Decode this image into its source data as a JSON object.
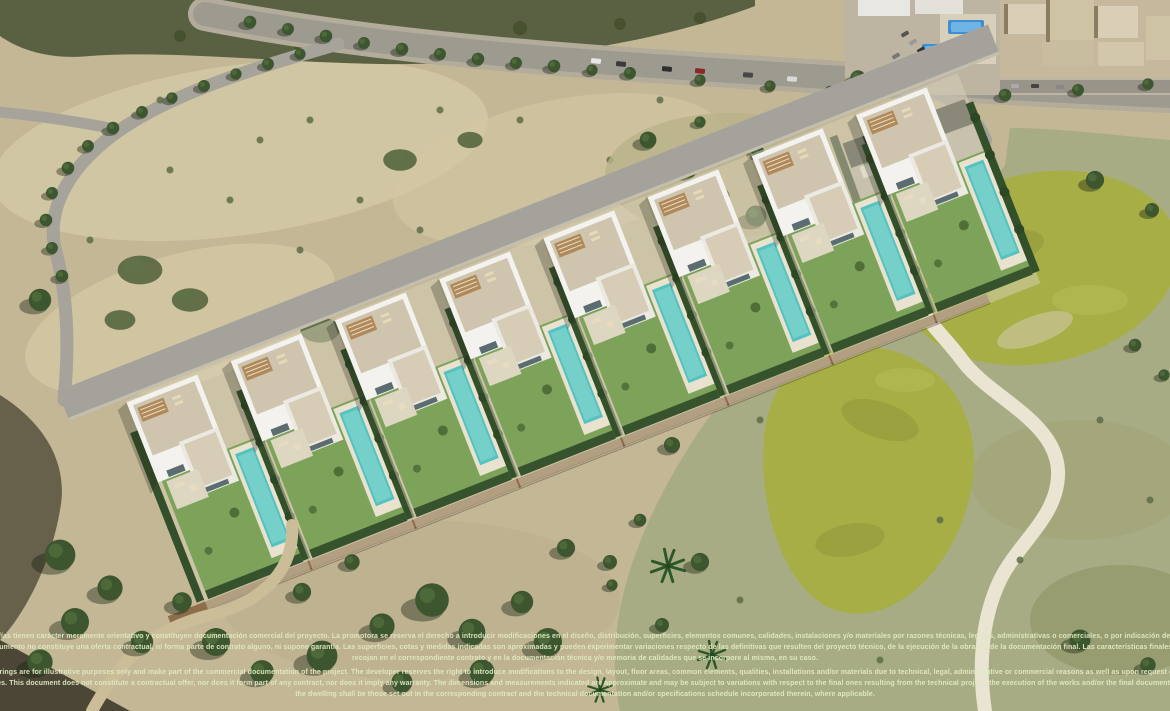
{
  "image": {
    "type": "aerial-architectural-render",
    "description": "Aerial view of a new-build row of white modern villas with private pools and hedged gardens beside a golf course, with tree-lined roads, an apartment complex with pools, a clubhouse and Mediterranean scrubland",
    "features": [
      "villa-row",
      "private-pools",
      "lawns",
      "cypress-hedges",
      "boundary-wall",
      "golf-course",
      "cart-path",
      "tree-lined-avenue",
      "roads-with-cars",
      "apartment-complex",
      "clubhouse",
      "scrubland",
      "palm-trees"
    ]
  },
  "disclaimer": {
    "es": "Los presentes planos e infografías tienen carácter meramente orientativo y constituyen documentación comercial del proyecto. La promotora se reserva el derecho a introducir modificaciones en el diseño, distribución, superficies, elementos comunes, calidades, instalaciones y/o materiales por razones técnicas, legales, administrativas o comerciales, o por indicación de la Dirección Facultativa o de la autoridad competente. Este documento no constituye una oferta contractual, ni forma parte de contrato alguno, ni supone garantía. Las superficies, cotas y medidas indicadas son aproximadas y pueden experimentar variaciones respecto de las definitivas que resulten del proyecto técnico, de la ejecución de la obra y/o de la documentación final. Las características finales de la vivienda serán las que se recojan en el correspondiente contrato y en la documentación técnica y/o memoria de calidades que se incorpore al mismo, en su caso.",
    "en": "The present drawings and renderings are for illustrative purposes only and make part of the commercial documentation of the project. The developer reserves the right to introduce modifications to the design, layout, floor areas, common elements, qualities, installations and/or materials due to technical, legal, administrative or commercial reasons as well as upon request of the Project Management Team or the relevant government bodies. This document does not constitute a contractual offer, nor does it form part of any contract, nor does it imply any warranty. The dimensions and measurements indicated are approximate and may be subject to variations with respect to the final ones resulting from the technical project, the execution of the works and/or the final documentation. The final characteristics of the dwelling shall be those set out in the corresponding contract and the technical documentation and/or specifications schedule incorporated therein, where applicable."
  },
  "colors": {
    "villa_white": "#f3f2ee",
    "roof_tan": "#cfc5ae",
    "pool_turquoise": "#54c2c0",
    "apartment_pool_blue": "#3d8ed2",
    "lawn_green": "#7da35b",
    "hedge_green": "#33502a",
    "golf_rough": "#a8ac85",
    "golf_green": "#a7ae45",
    "cart_path": "#eae4d2",
    "scrub_sand": "#c3b796",
    "road_grey": "#9d9a90",
    "wall_brown": "#8d6d4a",
    "disclaimer_text": "#dfe9c1"
  }
}
